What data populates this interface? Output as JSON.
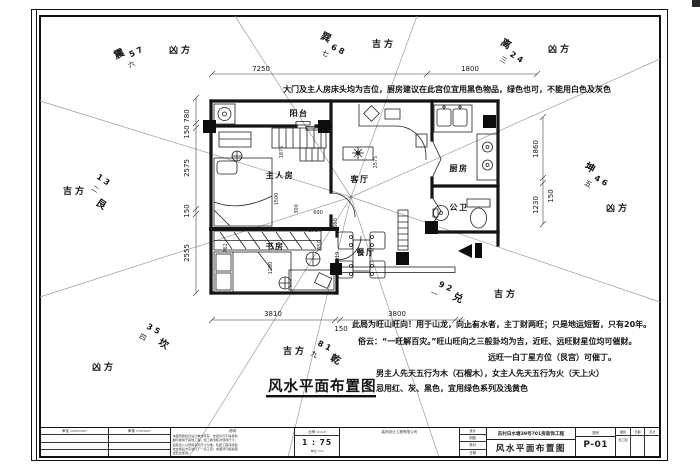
{
  "annotations": {
    "top_note": "大门及主人房床头均为吉位，厨房建议在此宫位宜用黑色物品，绿色也可，不能用白色及灰色",
    "notes": [
      "此局为旺山旺向！用于山龙，向上有水者，主丁财两旺；只是地运短暂，只有20年。",
      "俗云：“一旺解百灾。”旺山旺向之三般卦均为吉，近旺、远旺财星位均可催财。",
      "远旺一白丁星方位（艮宫）可催丁。",
      "男主人先天五行为木（石榴木），女主人先天五行为火（天上火）",
      "忌用红、灰、黑色，宜用绿色系列及浅黄色"
    ],
    "caption": "风水平面布置图"
  },
  "rooms": [
    "阳台",
    "主人房",
    "客厅",
    "厨房",
    "公卫",
    "书房",
    "餐厅"
  ],
  "sectors": [
    {
      "trigram": "震",
      "stars": "5 7",
      "numeral": "六",
      "luck": "凶方"
    },
    {
      "trigram": "巽",
      "stars": "6 8",
      "numeral": "七",
      "luck": "吉方"
    },
    {
      "trigram": "离",
      "stars": "2 4",
      "numeral": "三",
      "luck": "凶方"
    },
    {
      "trigram": "坤",
      "stars": "4 6",
      "numeral": "五",
      "luck": "凶方"
    },
    {
      "trigram": "兑",
      "stars": "9 2",
      "numeral": "一",
      "luck": "吉方"
    },
    {
      "trigram": "乾",
      "stars": "8 1",
      "numeral": "九",
      "luck": "吉方"
    },
    {
      "trigram": "坎",
      "stars": "3 5",
      "numeral": "四",
      "luck": "凶方"
    },
    {
      "trigram": "艮",
      "stars": "1 3",
      "numeral": "二",
      "luck": "吉方"
    }
  ],
  "dimensions": {
    "top": [
      "7250",
      "1800"
    ],
    "left": [
      "780",
      "150",
      "2575",
      "150",
      "2555"
    ],
    "right": [
      "1860",
      "150",
      "1230"
    ],
    "bottom": [
      "3810",
      "150",
      "3800",
      "150"
    ],
    "interior": [
      "1875",
      "2575",
      "1500",
      "300",
      "600",
      "600",
      "670",
      "650",
      "762",
      "1280",
      "1119"
    ]
  },
  "title_block": {
    "approve_label": "审定",
    "approve_sub": "APPROVED",
    "check_label": "审核",
    "check_sub": "CHECKED",
    "notes_label": "说明",
    "notes_lines": [
      "本图纸版权归设计单位所有，未经许可不得复制",
      "翻印或用于其他工程；施工前须核对现场尺寸，",
      "如有出入以现场实际尺寸为准；隐蔽工程须经验",
      "收合格后方可进行下一道工序；本图须与相关图",
      "纸配合使用。"
    ],
    "scale_label": "比例",
    "scale_sub": "SCALE",
    "scale_value": "1 : 75",
    "unit_label": "单位",
    "unit_value": "mm",
    "company": "装饰设计工程有限公司",
    "staff": [
      {
        "k": "设计"
      },
      {
        "k": "制图"
      },
      {
        "k": "校对"
      },
      {
        "k": "日期"
      }
    ],
    "project_name": "员村白水塘39号701房装饰工程",
    "drawing_name": "风水平面布置图",
    "no_label": "图号",
    "drawing_no": "P-01",
    "right_cells": [
      {
        "t": "图别",
        "b": "施工图"
      },
      {
        "t": "日期",
        "b": ""
      },
      {
        "t": "页次",
        "b": ""
      }
    ]
  }
}
